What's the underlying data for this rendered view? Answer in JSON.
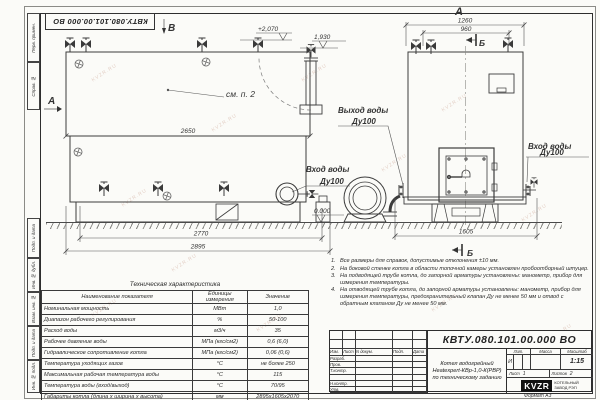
{
  "watermark": {
    "text": "KVZR.RU"
  },
  "frame": {
    "doc_number_top": "КВТУ.080.101.00.000  ВО",
    "margin_labels": [
      "Перв. примен.",
      "Справ. №",
      "Подп. и дата",
      "Инв. № дубл.",
      "Взам. инв. №",
      "Подп. и дата",
      "Инв. № подл."
    ],
    "format_note": "Формат А3"
  },
  "drawing": {
    "views": {
      "side_arrow": "А",
      "top_arrow": "В",
      "front_title": "А",
      "section": "Б"
    },
    "callout": "см. п. 2",
    "labels": {
      "outlet_line1": "Выход воды",
      "outlet_line2": "Ду100",
      "inlet_line1": "Вход воды",
      "inlet_line2": "Ду100"
    },
    "dimensions": {
      "left_top": "2650",
      "left_mid": "2770",
      "left_total": "2895",
      "right_total": "1260",
      "right_inner": "960",
      "right_base": "1605"
    },
    "elevations": {
      "top": "+2,070",
      "outlet": "1,930",
      "ground": "0.000"
    }
  },
  "notes": {
    "items": [
      {
        "num": "1.",
        "text": "Все размеры для справок, допустимые отклонения ±10 мм."
      },
      {
        "num": "2.",
        "text": "На боковой стенке котла в области топочной камеры установлен пробоотборный штуцер."
      },
      {
        "num": "3.",
        "text": "На подводящей трубе котла, до запорной арматуры установлены: манометр, прибор для измерения температуры."
      },
      {
        "num": "4.",
        "text": "На отводящей трубе котла, до запорной арматуры установлены: манометр, прибор для измерения температуры, предохранительный клапан Ду не менее 50 мм и отвод с обратным клапаном Ду не менее 50 мм."
      }
    ]
  },
  "tech_table": {
    "title": "Техническая характеристика",
    "headers": [
      "Наименование показателя",
      "Единицы измерения",
      "Значение"
    ],
    "rows": [
      {
        "param": "Номинальная мощность",
        "unit": "МВт",
        "value": "1,0"
      },
      {
        "param": "Диапазон рабочего регулирования",
        "unit": "%",
        "value": "50-100"
      },
      {
        "param": "Расход воды",
        "unit": "м3/ч",
        "value": "35"
      },
      {
        "param": "Рабочее давление воды",
        "unit": "МПа (кгс/см2)",
        "value": "0,6 (6,0)"
      },
      {
        "param": "Гидравлическое сопротивление котла",
        "unit": "МПа (кгс/см2)",
        "value": "0,06 (0,6)"
      },
      {
        "param": "Температура уходящих газов",
        "unit": "°С",
        "value": "не более 250"
      },
      {
        "param": "Максимальная рабочая температура воды",
        "unit": "°С",
        "value": "115"
      },
      {
        "param": "Температура воды (вход/выход)",
        "unit": "°С",
        "value": "70/95"
      },
      {
        "param": "Габариты котла (длина х ширина х высота)",
        "unit": "мм",
        "value": "2895х1605х2070"
      }
    ]
  },
  "title_block": {
    "doc_number": "КВТУ.080.101.00.000  ВО",
    "title_line1": "Котел водогрейный",
    "title_line2": "Heatexpert-КВр-1,0-К(РВР)",
    "title_line3": "по техническому заданию",
    "columns": [
      "Изм.",
      "Лист",
      "N докум.",
      "Подп.",
      "Дата"
    ],
    "roles": [
      "Разраб.",
      "Пров.",
      "Т.контр.",
      "",
      "Н.контр.",
      "Утв."
    ],
    "lit_header": "Лит.",
    "mass_header": "Масса",
    "scale_header": "Масштаб",
    "lit_value": "И",
    "scale_value": "1:15",
    "sheet_label": "Лист",
    "sheet_value": "1",
    "sheets_label": "Листов",
    "sheets_value": "2",
    "logo_text": "KVZR",
    "logo_sub1": "КОТЕЛЬНЫЙ",
    "logo_sub2": "ЗАВОД РЭП"
  }
}
